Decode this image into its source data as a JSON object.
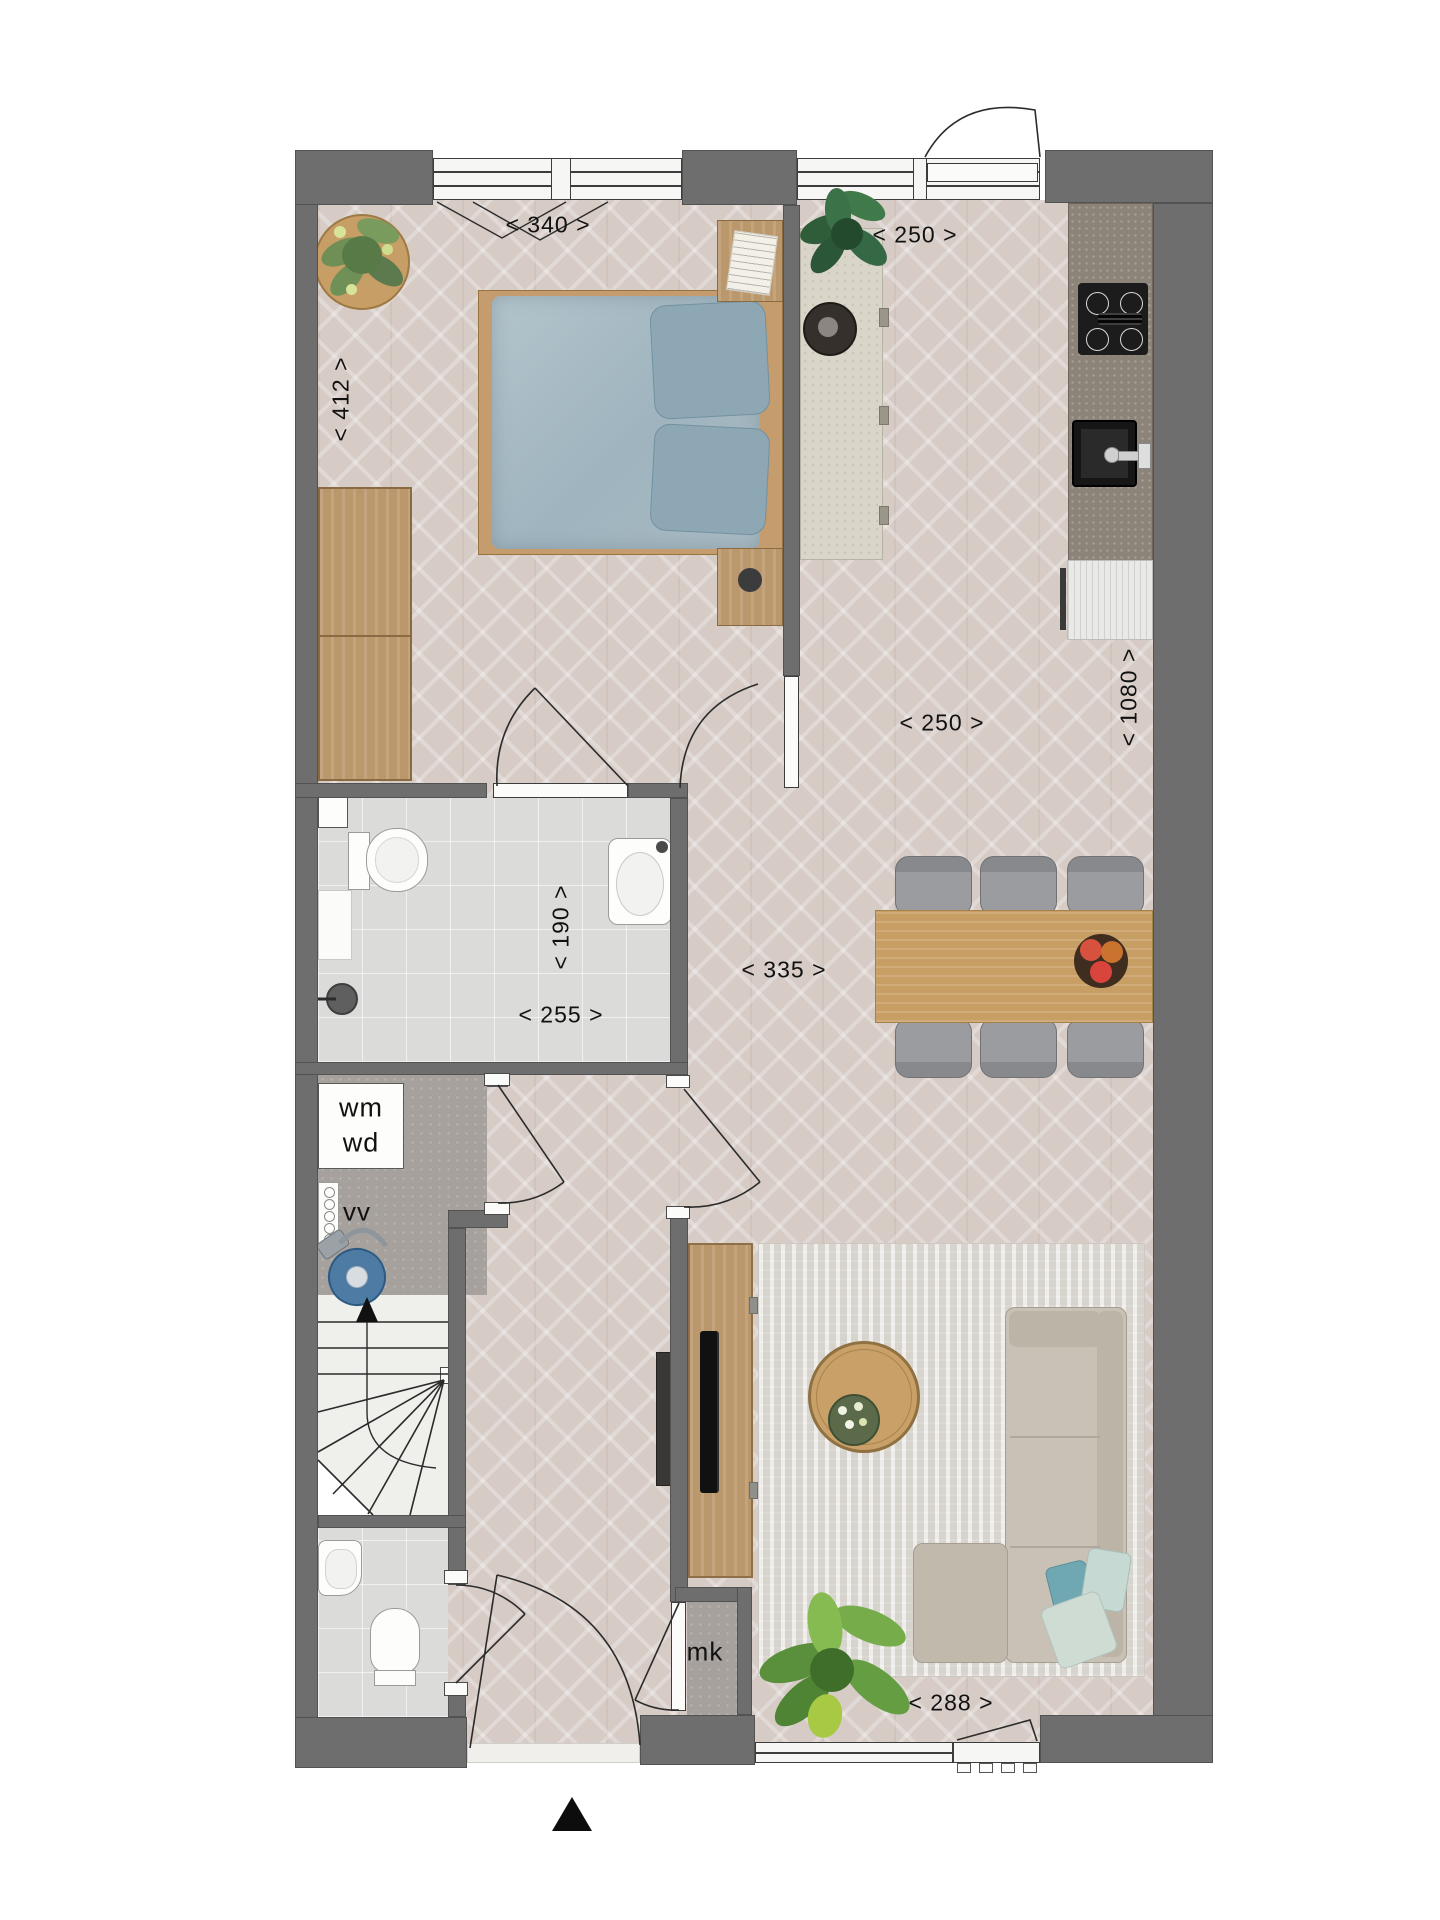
{
  "plan": {
    "dims": {
      "bedroom_width": "< 340 >",
      "bedroom_depth": "< 412 >",
      "kitchen_width": "< 250 >",
      "kitchen_run": "< 1080 >",
      "living_width": "< 250 >",
      "bathroom_width": "< 190 >",
      "bathroom_length": "< 255 >",
      "hall_span": "< 335 >",
      "facade_width": "< 288 >"
    },
    "labels": {
      "washing_machine": "wm",
      "dryer": "wd",
      "ventilation_unit": "vv",
      "meter_cupboard": "mk"
    },
    "colors": {
      "wall": "#6e6e6e",
      "wood_floor": "#d6cbc5",
      "tile_floor": "#dbdbd9",
      "concrete_floor": "#a6a19c",
      "kitchen_counter": "#8d8479",
      "table_wood": "#c79e63",
      "bed_textile": "#a9bcc4",
      "sofa": "#c9c1b6",
      "plant_green": "#6fa83e"
    }
  }
}
